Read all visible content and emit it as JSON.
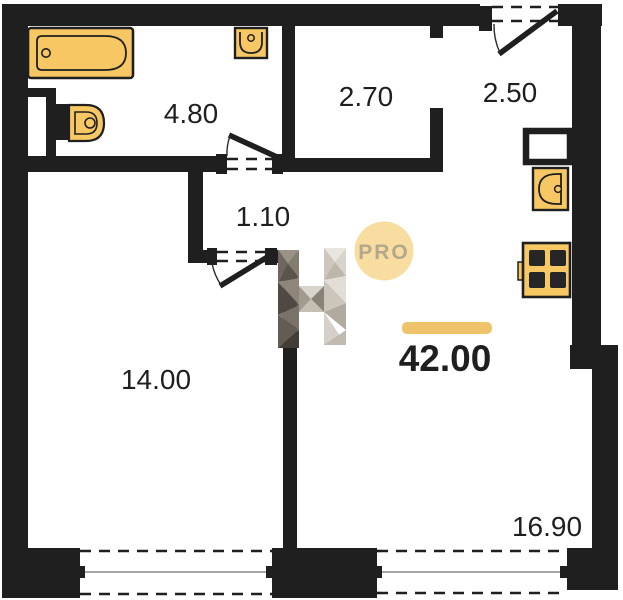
{
  "floor_plan": {
    "total_area_label": "42.00",
    "rooms": {
      "bathroom": "4.80",
      "wardrobe": "2.70",
      "entry": "2.50",
      "hall": "1.10",
      "bedroom": "14.00",
      "living_kitchen": "16.90"
    },
    "watermark": {
      "badge": "PRO",
      "logo_letter": "H"
    },
    "fixtures": [
      "bathtub",
      "washbasin",
      "toilet",
      "duct-shaft",
      "kitchen-sink",
      "stove"
    ],
    "colors": {
      "wall": "#1f1f1f",
      "fixture_fill": "#f7c763",
      "accent_bar": "#efc36b",
      "pro_badge_fill": "#f8dca0",
      "pro_badge_text": "#b3a88c",
      "window_line": "#8a8a8a"
    }
  }
}
